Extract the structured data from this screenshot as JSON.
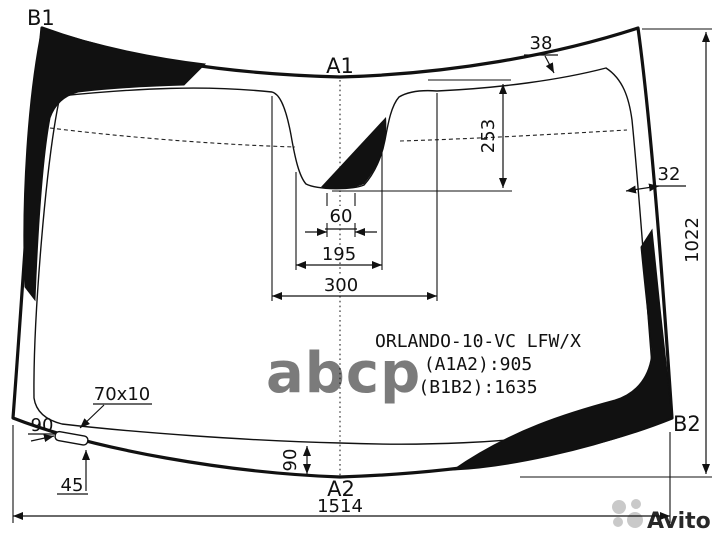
{
  "title": {
    "part_code": "ORLANDO-10-VC LFW/X",
    "a1a2": "(A1A2):905",
    "b1b2": "(B1B2):1635"
  },
  "corner_labels": {
    "top_left": "B1",
    "top_center": "A1",
    "bottom_right": "B2",
    "bottom_center": "A2"
  },
  "dimensions": {
    "top_band_width": "38",
    "mirror_cutout_depth": "253",
    "side_band_width": "32",
    "glass_height": "1022",
    "mirror_cutout_width_inner": "60",
    "mirror_cutout_width_mid": "195",
    "mirror_cutout_width_outer": "300",
    "bottom_band_height": "90",
    "glass_width": "1514",
    "sticker_size": "70x10",
    "sticker_offset_left": "90",
    "sticker_offset_bottom": "45"
  },
  "watermarks": {
    "abcp": "abcp",
    "avito": "Avito"
  },
  "colors": {
    "line": "#111111",
    "watermark_abcp": "#a8a8a8",
    "watermark_avito": "#c4c4c4"
  }
}
